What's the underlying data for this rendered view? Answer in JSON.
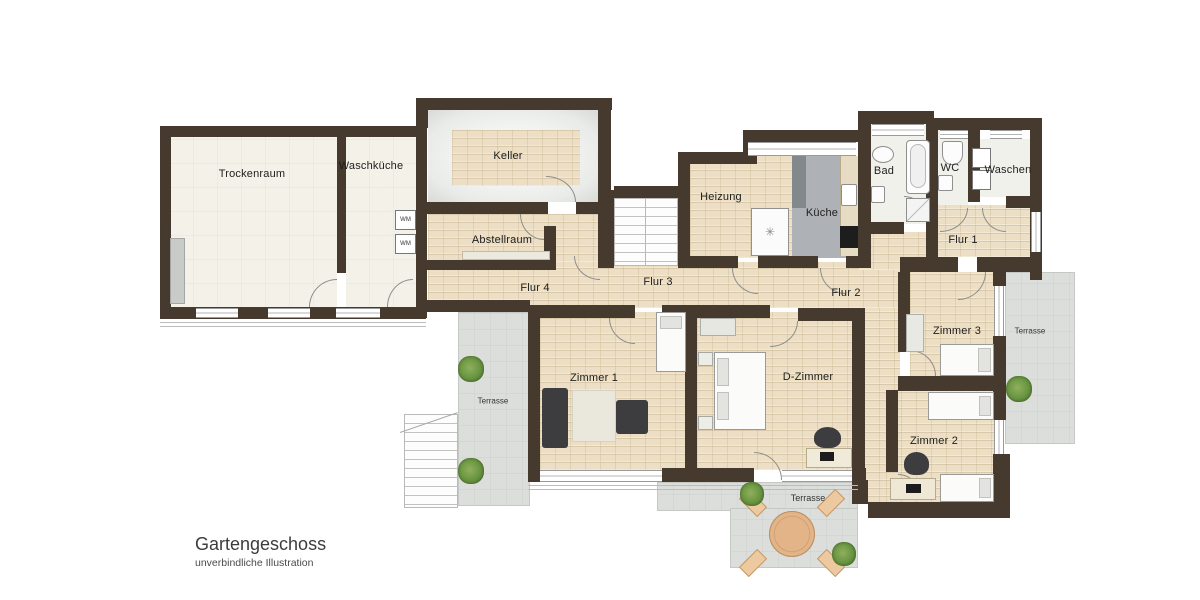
{
  "title": {
    "main": "Gartengeschoss",
    "subtitle": "unverbindliche Illustration"
  },
  "rooms": {
    "trockenraum": "Trockenraum",
    "waschkueche": "Waschküche",
    "keller": "Keller",
    "abstellraum": "Abstellraum",
    "flur1": "Flur 1",
    "flur2": "Flur 2",
    "flur3": "Flur 3",
    "flur4": "Flur 4",
    "heizung": "Heizung",
    "kueche": "Küche",
    "bad": "Bad",
    "wc": "WC",
    "waschen": "Waschen",
    "zimmer1": "Zimmer 1",
    "zimmer2": "Zimmer 2",
    "zimmer3": "Zimmer 3",
    "d_zimmer": "D-Zimmer",
    "terrasse": "Terrasse"
  },
  "appliances": {
    "wm": "WM"
  },
  "colors": {
    "wall": "#46392d",
    "floor_hall": "#ecdfc5",
    "floor_room": "#f4f1e8",
    "terrace": "#dcdedc",
    "kitchen_floor": "#aeb2b6",
    "plant": "#5d8f3c",
    "furniture_dark": "#3d3d40",
    "table_wood": "#e2b488"
  }
}
